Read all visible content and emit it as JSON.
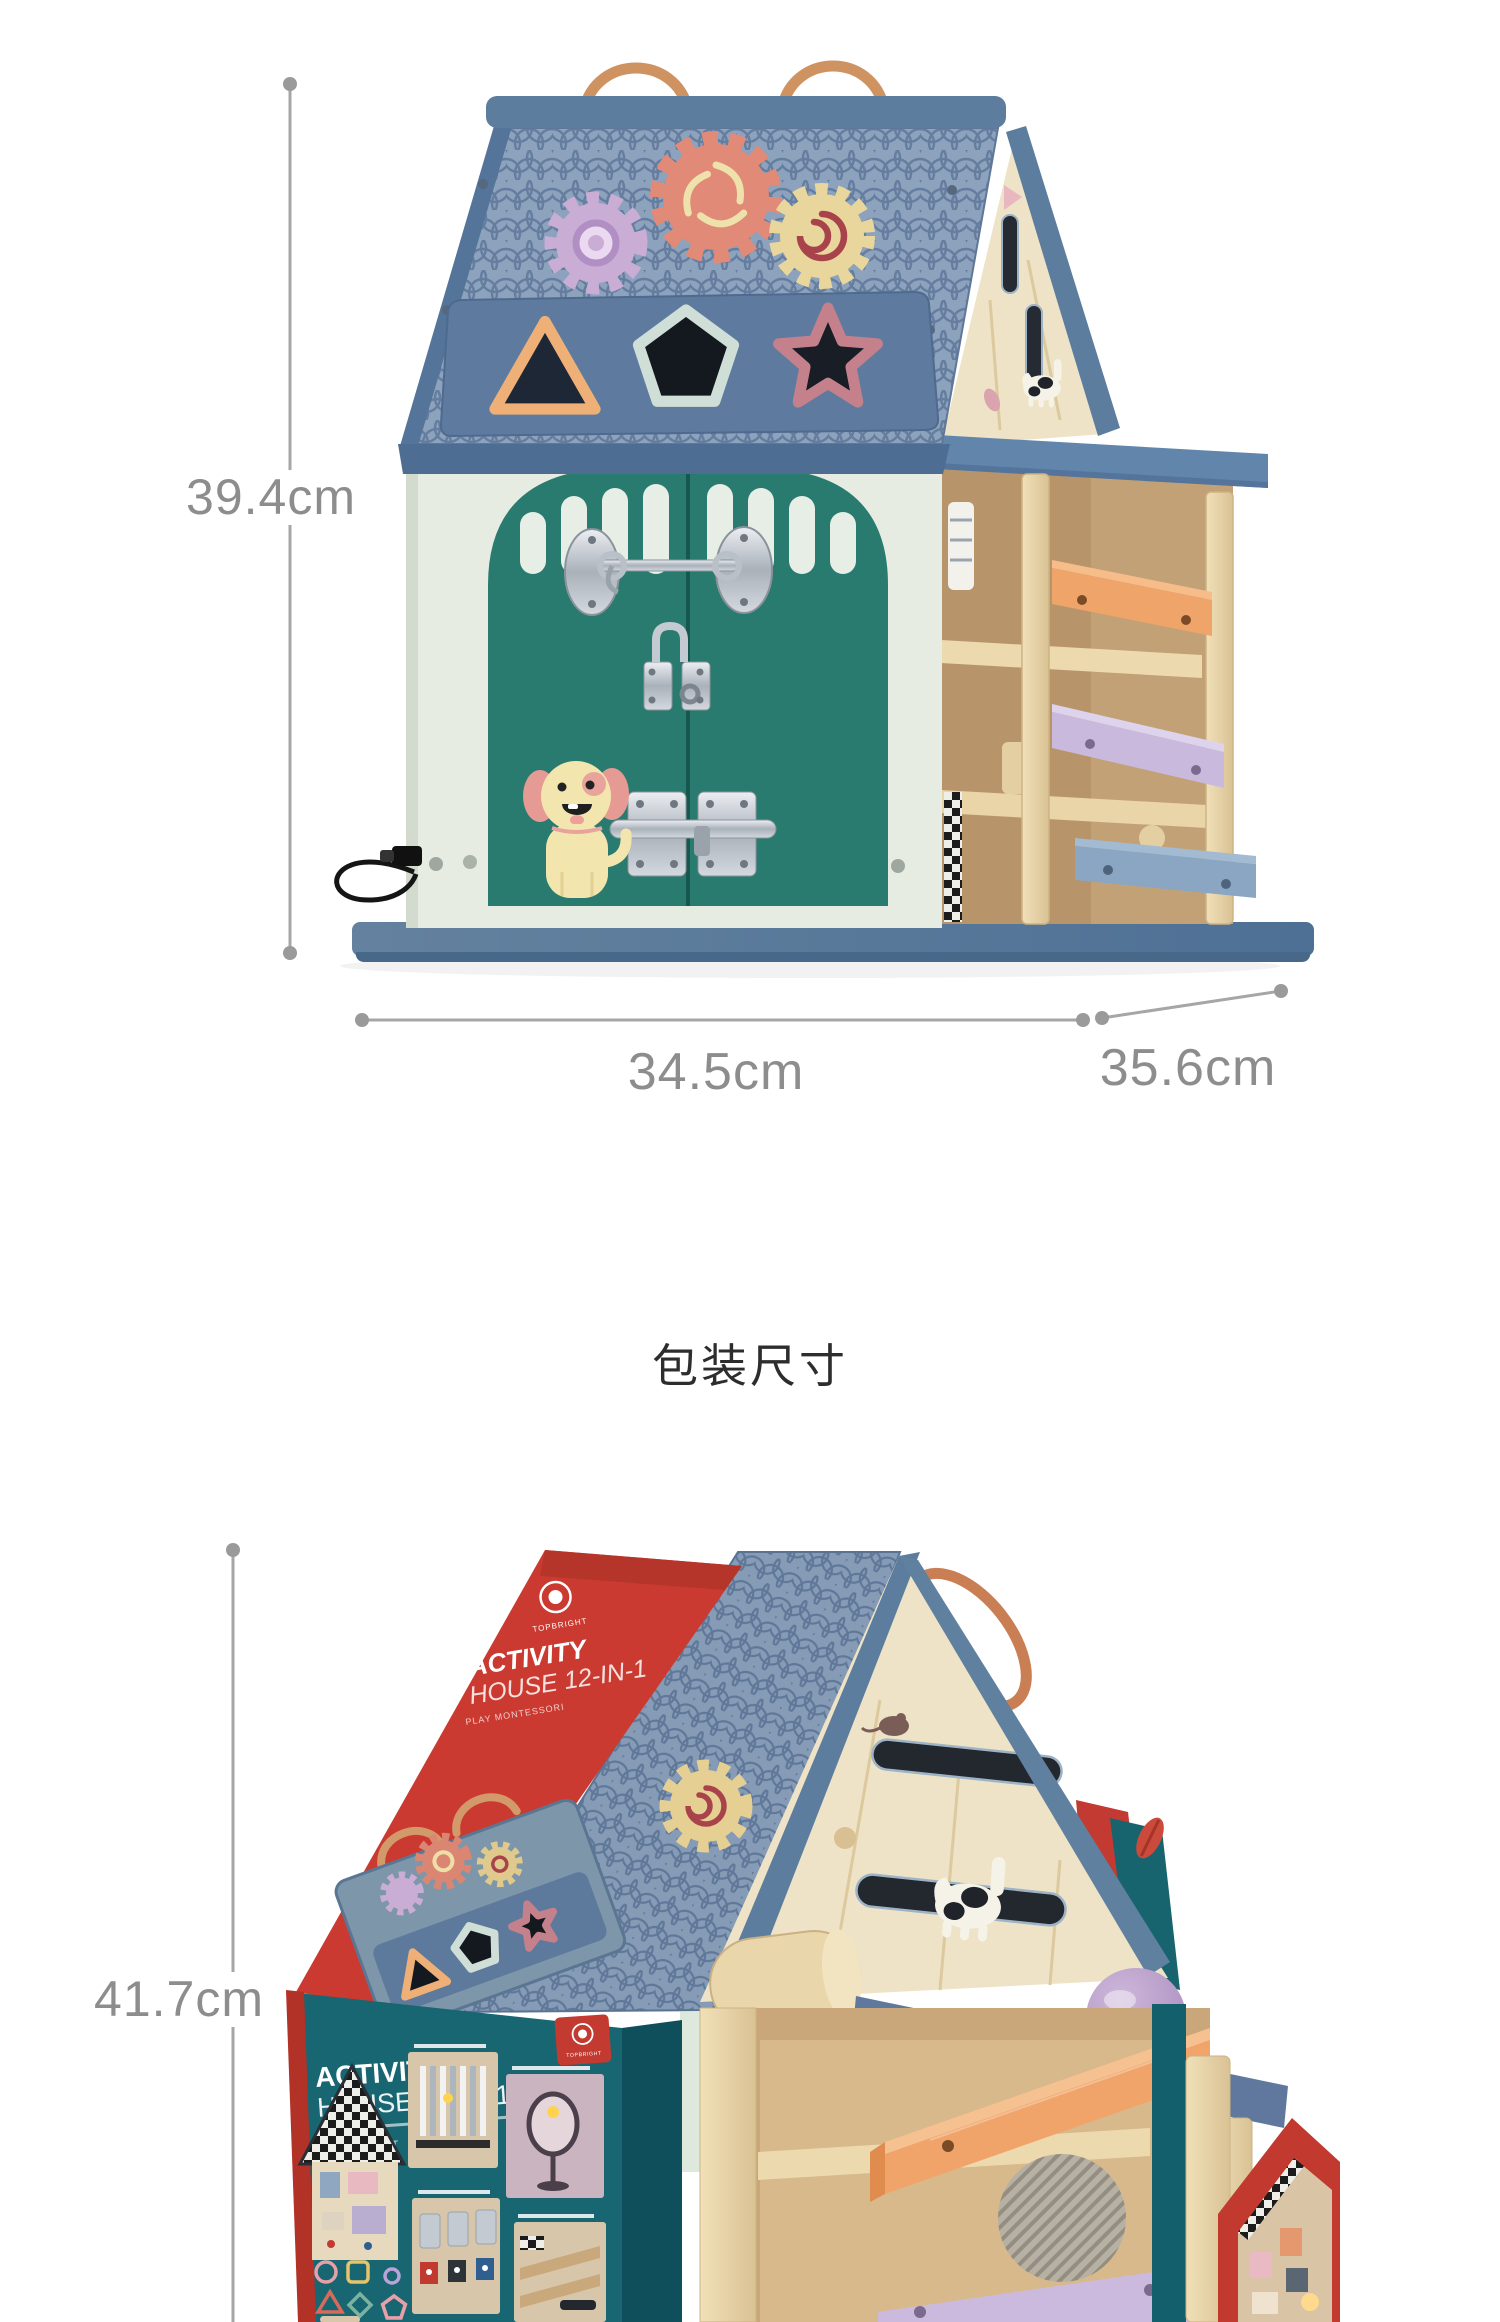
{
  "page": {
    "width": 1500,
    "height": 2322,
    "background": "#ffffff"
  },
  "top_figure": {
    "height_label": "39.4cm",
    "width_label": "34.5cm",
    "depth_label": "35.6cm"
  },
  "packaging": {
    "heading": "包装尺寸",
    "height_label": "41.7cm",
    "box": {
      "brand": "TOPBRIGHT",
      "sleeve_title_line1": "ACTIVITY",
      "sleeve_title_line2": "HOUSE 12-IN-1",
      "sleeve_subtitle": "PLAY MONTESSORI",
      "front_title_line1": "ACTIVITY",
      "front_title_line2": "HOUSE 12-IN-1",
      "front_content_label": "CONTENT",
      "front_badge_brand": "TOPBRIGHT"
    }
  },
  "colors": {
    "measure_line": "#a6a6a6",
    "measure_text": "#8d8d8d",
    "heading_text": "#2d2d2d",
    "roof_blue": "#8ca2bd",
    "roof_panel_blue": "#5e7b9f",
    "ridge_slate": "#5d7d9e",
    "door_teal": "#2a7b6f",
    "wall_cream": "#e7ece2",
    "base_slate": "#5e81a5",
    "wood": "#e7d4a9",
    "ramp_orange": "#efa469",
    "ramp_lavender": "#c9badd",
    "ramp_slate": "#8aa6c2",
    "gear_purple": "#c9add5",
    "gear_coral": "#e08a77",
    "gear_yellow": "#e8d69c",
    "handle_orange": "#cf9261",
    "box_red": "#cb3a30",
    "box_teal": "#176672",
    "dog_body": "#f3e5ae"
  }
}
